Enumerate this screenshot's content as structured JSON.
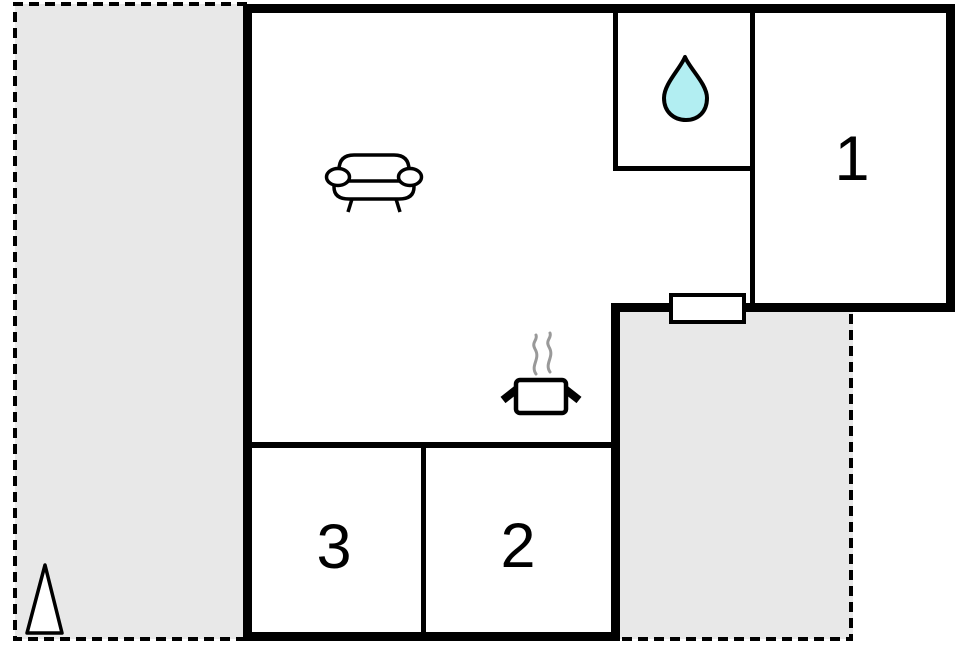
{
  "floorplan": {
    "rooms": [
      {
        "id": "bedroom-1",
        "label": "1"
      },
      {
        "id": "bedroom-2",
        "label": "2"
      },
      {
        "id": "bedroom-3",
        "label": "3"
      }
    ],
    "icons": [
      "sofa-icon",
      "cooking-pot-icon",
      "steam-icon",
      "water-drop-icon",
      "tree-icon"
    ],
    "colors": {
      "wall": "#000000",
      "terrace_fill": "#e8e8e8",
      "room_fill": "#ffffff",
      "water_drop_fill": "#b2eef2",
      "steam": "#999999",
      "label_text": "#000000"
    }
  }
}
